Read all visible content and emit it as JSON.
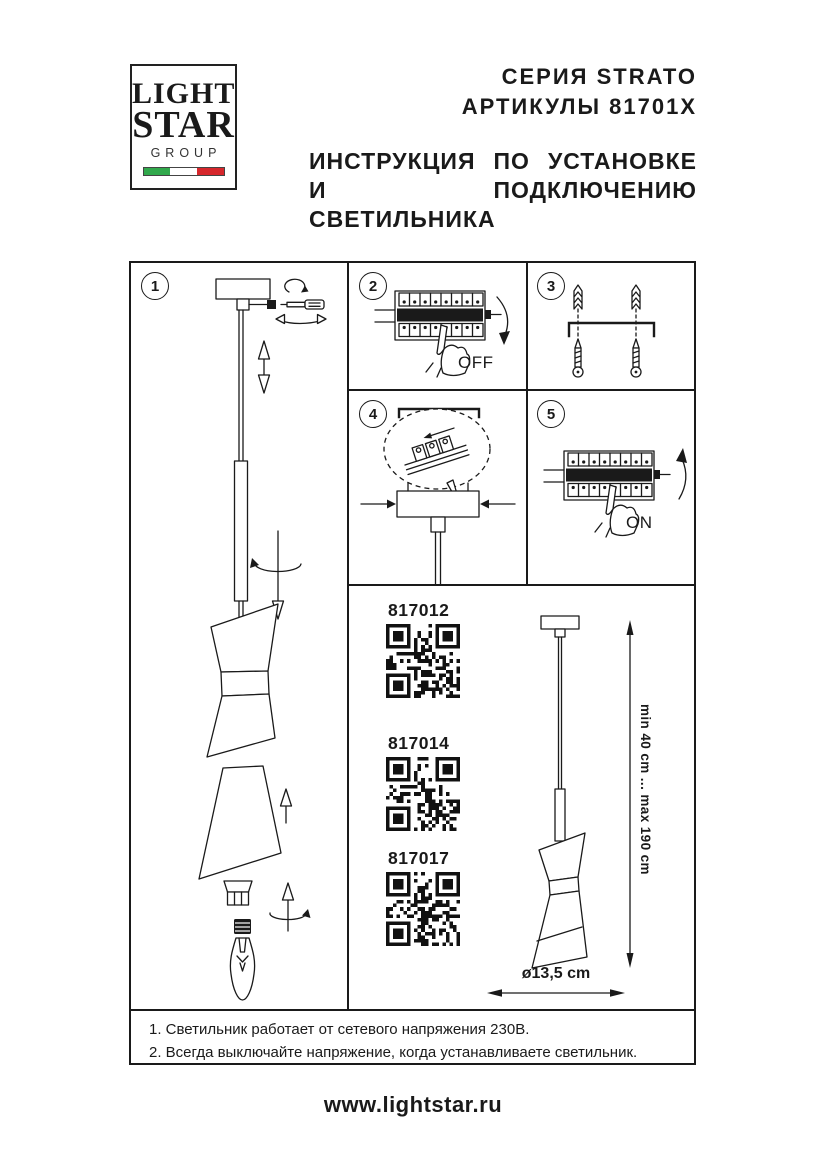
{
  "logo": {
    "line1": "LIGHT",
    "line2": "STAR",
    "line3": "GROUP"
  },
  "header": {
    "series": "СЕРИЯ STRATO",
    "articles_line": "АРТИКУЛЫ 81701X",
    "title_line1": "ИНСТРУКЦИЯ ПО УСТАНОВКЕ",
    "title_line2": "И ПОДКЛЮЧЕНИЮ СВЕТИЛЬНИКА"
  },
  "diagram": {
    "panels": [
      {
        "number": "1"
      },
      {
        "number": "2",
        "label": "OFF"
      },
      {
        "number": "3"
      },
      {
        "number": "4"
      },
      {
        "number": "5",
        "label": "ON"
      }
    ],
    "catalog": {
      "articles": [
        "817012",
        "817014",
        "817017"
      ],
      "height_range": "min 40 cm ... max 190 cm",
      "diameter": "ø13,5 cm"
    }
  },
  "notes": [
    "1. Светильник работает от сетевого напряжения 230В.",
    "2. Всегда выключайте напряжение, когда устанавливаете светильник."
  ],
  "footer": {
    "website": "www.lightstar.ru"
  },
  "colors": {
    "ink": "#1a1a1a",
    "flag_green": "#31a94c",
    "flag_white": "#ffffff",
    "flag_red": "#d6272c"
  }
}
